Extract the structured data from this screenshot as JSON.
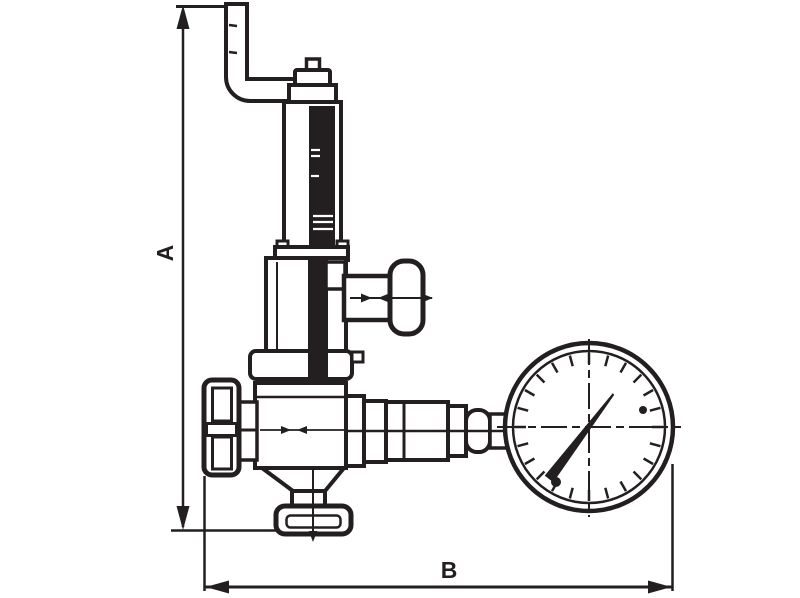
{
  "drawing": {
    "colors": {
      "line": "#231f20",
      "fill": "#ffffff",
      "background": "#ffffff"
    },
    "dimension_labels": {
      "a": "A",
      "b": "B"
    },
    "gauge": {
      "tick_count": 24,
      "tick_step_deg": 15,
      "tick_r_inner": 63,
      "tick_r_outer": 74,
      "cx": 589,
      "cy": 427
    }
  }
}
